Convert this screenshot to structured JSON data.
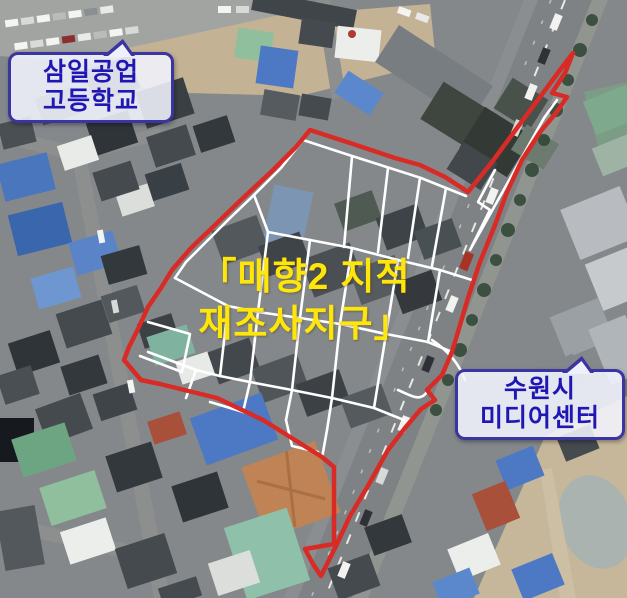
{
  "map": {
    "district_label": {
      "line1": "「매향2 지적",
      "line2": "재조사지구」"
    },
    "callouts": {
      "school": {
        "line1": "삼일공업",
        "line2": "고등학교"
      },
      "media_center": {
        "line1": "수원시",
        "line2": "미디어센터"
      }
    },
    "annotation_colors": {
      "boundary": "#d92b26",
      "parcels": "#ffffff",
      "district_label_text": "#ffe60a",
      "callout_text": "#1f16b4",
      "callout_border": "#3a35a0"
    }
  }
}
